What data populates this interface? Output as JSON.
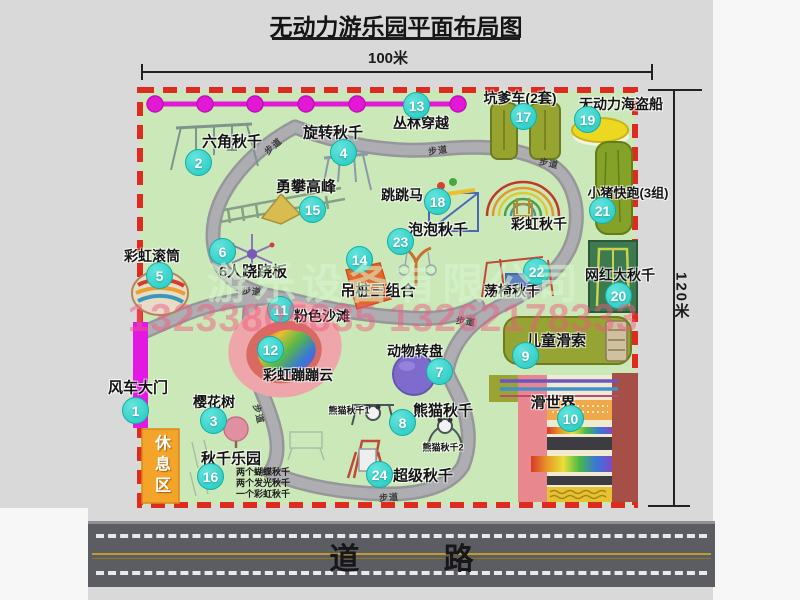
{
  "title": "无动力游乐园平面布局图",
  "scale": {
    "width": "100米",
    "height": "120米"
  },
  "road": {
    "label": "道  路"
  },
  "zones": {
    "rest_area": "休息区"
  },
  "watermarks": {
    "company": "游乐设备有限公司",
    "phone": "13233805835 13262178333"
  },
  "path_label_text": "步道",
  "colors": {
    "map_green": "#cbe9b8",
    "border_red": "#de2b20",
    "badge_cyan": "#2fd4cd",
    "zipline_magenta": "#e218d6",
    "gate_magenta": "#e318e3",
    "rest_orange": "#f4a428",
    "road_gray": "#5c5c63"
  },
  "attractions": [
    {
      "num": "1",
      "name": "风车大门",
      "bx": 136,
      "by": 411,
      "lx": 138,
      "ly": 387,
      "fs": 15
    },
    {
      "num": "2",
      "name": "六角秋千",
      "bx": 199,
      "by": 163,
      "lx": 232,
      "ly": 141,
      "fs": 15
    },
    {
      "num": "3",
      "name": "樱花树",
      "bx": 214,
      "by": 421,
      "lx": 214,
      "ly": 402,
      "fs": 14
    },
    {
      "num": "4",
      "name": "旋转秋千",
      "bx": 344,
      "by": 153,
      "lx": 333,
      "ly": 132,
      "fs": 15
    },
    {
      "num": "5",
      "name": "彩虹滚筒",
      "bx": 160,
      "by": 276,
      "lx": 152,
      "ly": 256,
      "fs": 14
    },
    {
      "num": "6",
      "name": "6人跷跷板",
      "bx": 223,
      "by": 252,
      "lx": 253,
      "ly": 271,
      "fs": 15
    },
    {
      "num": "7",
      "name": "动物转盘",
      "bx": 440,
      "by": 372,
      "lx": 415,
      "ly": 351,
      "fs": 14
    },
    {
      "num": "8",
      "name": "熊猫秋千",
      "bx": 403,
      "by": 423,
      "lx": 443,
      "ly": 410,
      "fs": 15
    },
    {
      "num": "9",
      "name": "儿童滑索",
      "bx": 526,
      "by": 356,
      "lx": 556,
      "ly": 340,
      "fs": 15
    },
    {
      "num": "10",
      "name": "滑世界",
      "bx": 571,
      "by": 419,
      "lx": 553,
      "ly": 402,
      "fs": 15
    },
    {
      "num": "11",
      "name": "粉色沙滩",
      "bx": 281,
      "by": 310,
      "lx": 322,
      "ly": 316,
      "fs": 14
    },
    {
      "num": "12",
      "name": "彩虹蹦蹦云",
      "bx": 271,
      "by": 350,
      "lx": 298,
      "ly": 375,
      "fs": 14
    },
    {
      "num": "13",
      "name": "丛林穿越",
      "bx": 417,
      "by": 106,
      "lx": 421,
      "ly": 123,
      "fs": 14
    },
    {
      "num": "14",
      "name": "吊桩三组合",
      "bx": 360,
      "by": 260,
      "lx": 378,
      "ly": 290,
      "fs": 15
    },
    {
      "num": "15",
      "name": "勇攀高峰",
      "bx": 313,
      "by": 210,
      "lx": 306,
      "ly": 186,
      "fs": 15
    },
    {
      "num": "16",
      "name": "秋千乐园",
      "bx": 211,
      "by": 477,
      "lx": 231,
      "ly": 458,
      "fs": 15
    },
    {
      "num": "17",
      "name": "坑爹车(2套)",
      "bx": 524,
      "by": 117,
      "lx": 520,
      "ly": 98,
      "fs": 14
    },
    {
      "num": "18",
      "name": "跳跳马",
      "bx": 438,
      "by": 202,
      "lx": 402,
      "ly": 195,
      "fs": 14
    },
    {
      "num": "19",
      "name": "无动力海盗船",
      "bx": 588,
      "by": 120,
      "lx": 621,
      "ly": 104,
      "fs": 14
    },
    {
      "num": "20",
      "name": "网红大秋千",
      "bx": 619,
      "by": 296,
      "lx": 620,
      "ly": 275,
      "fs": 14
    },
    {
      "num": "21",
      "name": "小猪快跑(3组)",
      "bx": 603,
      "by": 211,
      "lx": 628,
      "ly": 192,
      "fs": 13
    },
    {
      "num": "22",
      "name": "荡椅秋千",
      "bx": 537,
      "by": 272,
      "lx": 512,
      "ly": 291,
      "fs": 14
    },
    {
      "num": "23",
      "name": "泡泡秋千",
      "bx": 401,
      "by": 242,
      "lx": 438,
      "ly": 229,
      "fs": 15
    },
    {
      "num": "24",
      "name": "超级秋千",
      "bx": 380,
      "by": 475,
      "lx": 423,
      "ly": 475,
      "fs": 15
    }
  ],
  "extra_labels": [
    {
      "text": "彩虹秋千",
      "x": 539,
      "y": 224,
      "fs": 14
    },
    {
      "text": "熊猫秋千1",
      "x": 349,
      "y": 410,
      "fs": 9
    },
    {
      "text": "熊猫秋千2",
      "x": 443,
      "y": 447,
      "fs": 9
    }
  ],
  "swing_park_notes": [
    "两个蝴蝶秋千",
    "两个发光秋千",
    "一个彩虹秋千"
  ],
  "path_labels": [
    {
      "x": 273,
      "y": 146,
      "r": -42
    },
    {
      "x": 438,
      "y": 150,
      "r": -8
    },
    {
      "x": 549,
      "y": 163,
      "r": 12
    },
    {
      "x": 252,
      "y": 291,
      "r": 4
    },
    {
      "x": 466,
      "y": 321,
      "r": 8
    },
    {
      "x": 259,
      "y": 414,
      "r": 75
    },
    {
      "x": 389,
      "y": 497,
      "r": -4
    }
  ]
}
